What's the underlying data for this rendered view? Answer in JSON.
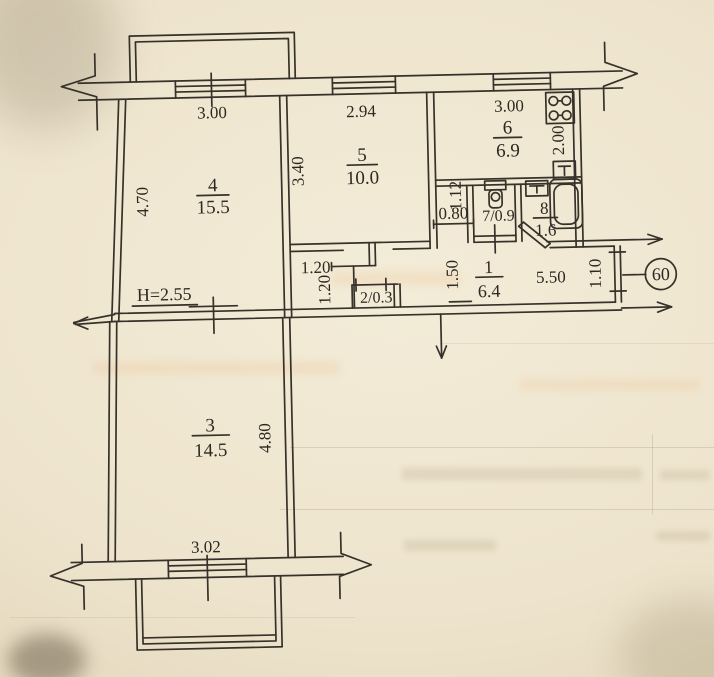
{
  "plan": {
    "unit_number": "60",
    "ceiling_height": "H=2.55",
    "rooms": {
      "r1": {
        "num": "1",
        "area": "6.4"
      },
      "r2": {
        "label": "2/0.3"
      },
      "r3": {
        "num": "3",
        "area": "14.5"
      },
      "r4": {
        "num": "4",
        "area": "15.5"
      },
      "r5": {
        "num": "5",
        "area": "10.0"
      },
      "r6": {
        "num": "6",
        "area": "6.9"
      },
      "r7": {
        "label": "7/0.9"
      },
      "r8": {
        "num": "8",
        "area": "1.6"
      }
    },
    "dims": {
      "win_room4": "3.00",
      "win_room5": "2.94",
      "win_kitchen": "3.00",
      "left_wall": "4.70",
      "room5_depth": "3.40",
      "kitchen_depth": "2.00",
      "nook_depth": "1.12",
      "nook_width": "0.80",
      "hall_left": "1.50",
      "closet_w": "1.20",
      "closet_h": "1.20",
      "hall_length": "5.50",
      "entry_width": "1.10",
      "room3_depth": "4.80",
      "room3_window": "3.02"
    }
  }
}
